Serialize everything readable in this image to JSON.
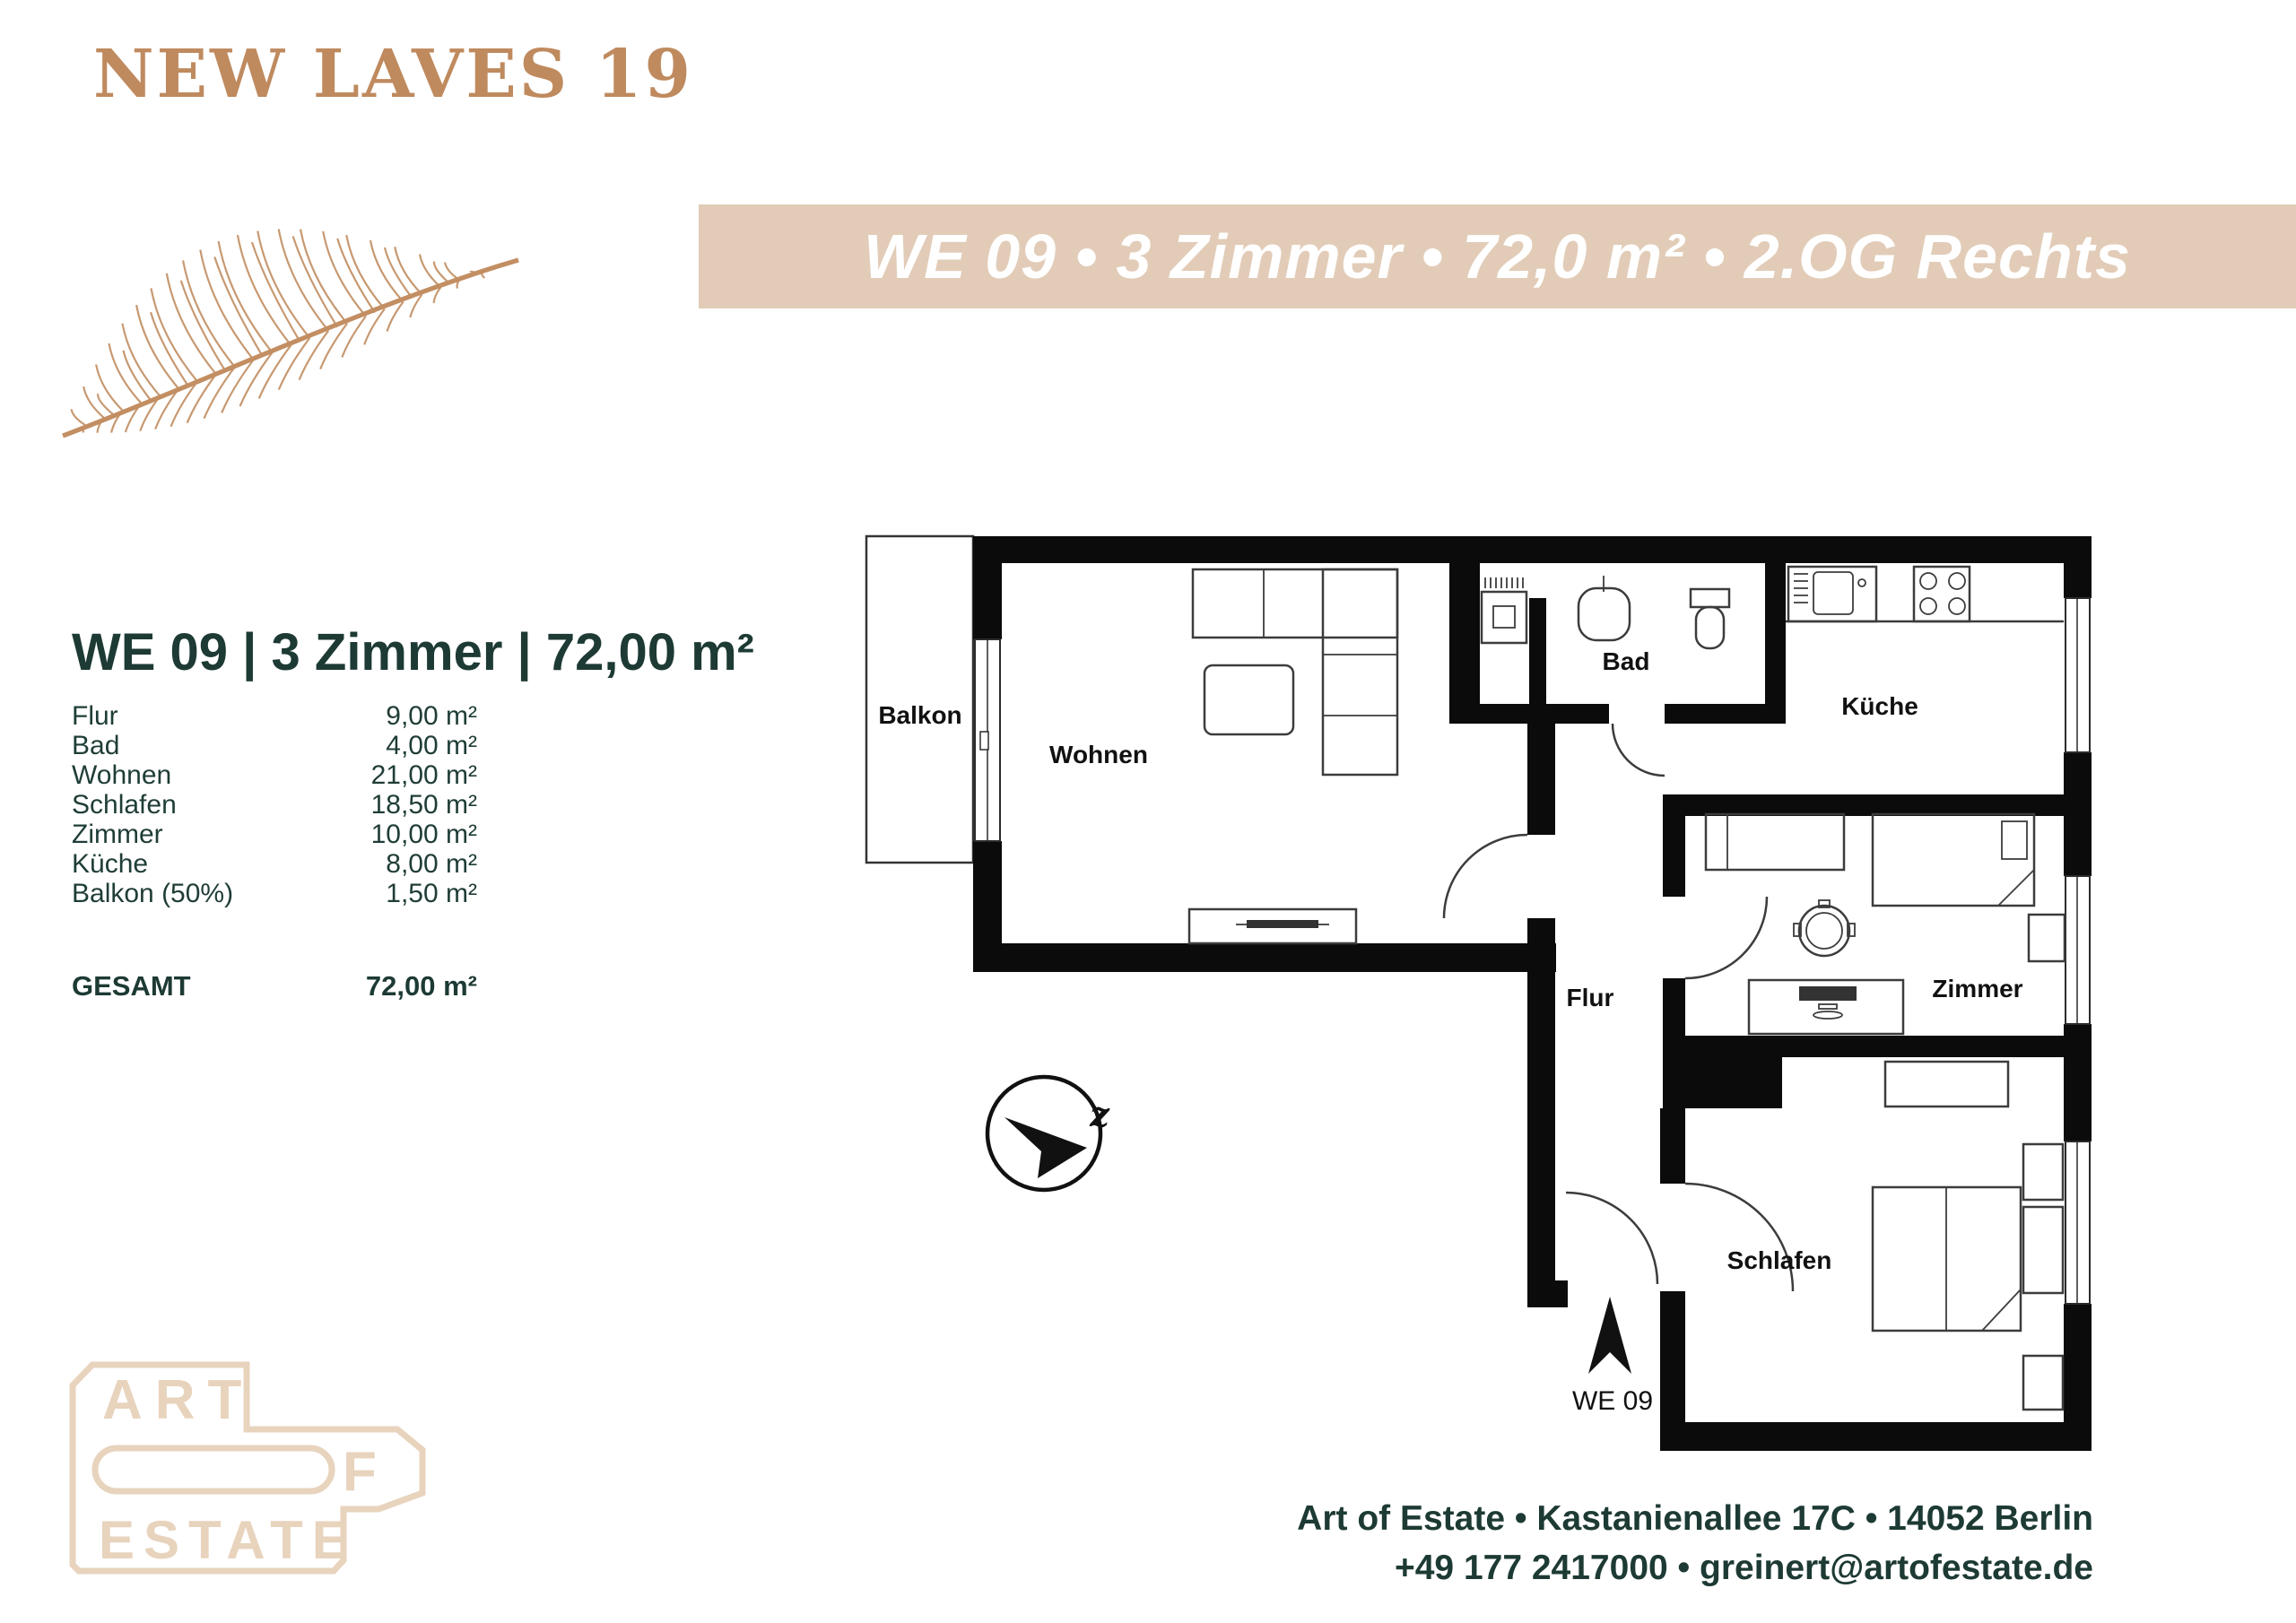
{
  "brand": {
    "name": "NEW LAVES 19"
  },
  "banner": {
    "text": "WE 09 • 3 Zimmer • 72,0 m² • 2.OG Rechts",
    "bg_color": "#e2ccb8"
  },
  "unit_summary": {
    "title": "WE 09 | 3 Zimmer | 72,00 m²",
    "rows": [
      {
        "label": "Flur",
        "value": "9,00 m²"
      },
      {
        "label": "Bad",
        "value": "4,00 m²"
      },
      {
        "label": "Wohnen",
        "value": "21,00 m²"
      },
      {
        "label": "Schlafen",
        "value": "18,50 m²"
      },
      {
        "label": "Zimmer",
        "value": "10,00 m²"
      },
      {
        "label": "Küche",
        "value": "8,00 m²"
      },
      {
        "label": "Balkon (50%)",
        "value": "1,50 m²"
      }
    ],
    "total_label": "GESAMT",
    "total_value": "72,00 m²"
  },
  "floorplan": {
    "labels": {
      "balkon": "Balkon",
      "wohnen": "Wohnen",
      "bad": "Bad",
      "kueche": "Küche",
      "flur": "Flur",
      "zimmer": "Zimmer",
      "schlafen": "Schlafen"
    },
    "unit_label": "WE 09",
    "compass_letter": "z"
  },
  "logo": {
    "art": "ART",
    "of_f": "F",
    "estate": "ESTATE"
  },
  "footer": {
    "line1": "Art of Estate • Kastanienallee 17C • 14052 Berlin",
    "line2": "+49 177 2417000 • greinert@artofestate.de"
  },
  "colors": {
    "accent_tan": "#bf8a5e",
    "leaf_tan": "#c28e62",
    "banner_beige": "#e2ccb8",
    "dark_teal": "#1d3a34",
    "logo_beige": "#e8d3bd",
    "plan_black": "#0b0b0b"
  }
}
